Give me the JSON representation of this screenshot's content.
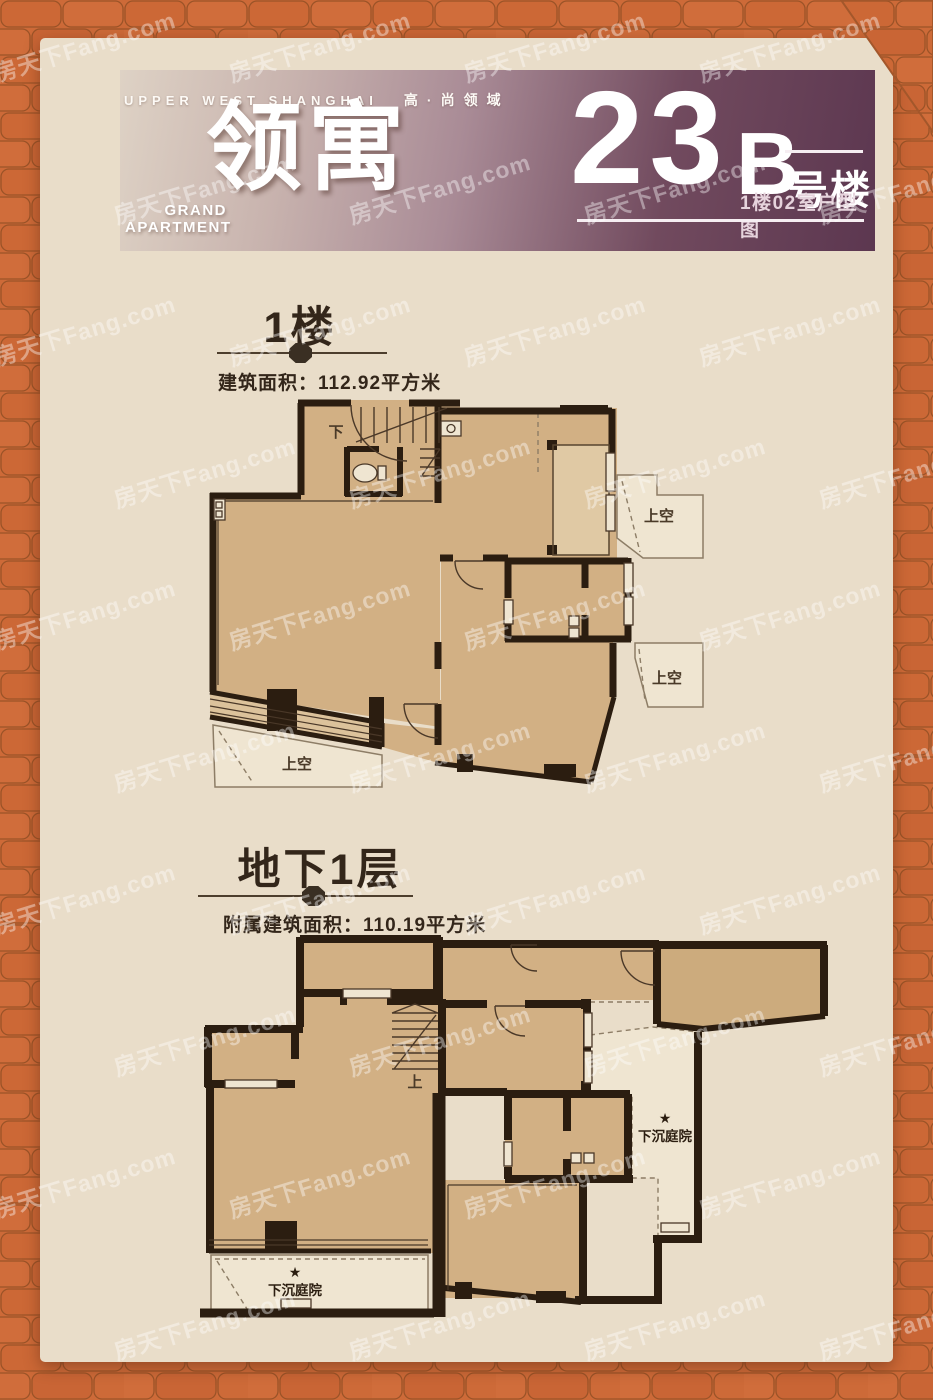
{
  "poster": {
    "tagline_en": "UPPER WEST SHANGHAI",
    "tagline_cn": "高·尚领域",
    "logo_cn": "领寓",
    "logo_en_top": "GRAND",
    "logo_en_bottom": "APARTMENT",
    "building_num": "23",
    "building_letter": "B",
    "building_suffix": "号楼",
    "unit_caption": "1楼02室户型图"
  },
  "floor1": {
    "title": "1楼",
    "area_label": "建筑面积：112.92平方米",
    "stair_direction": "下",
    "void_label": "上空"
  },
  "basement": {
    "title": "地下1层",
    "area_label": "附属建筑面积：110.19平方米",
    "stair_direction": "上",
    "courtyard_star": "★",
    "courtyard_label": "下沉庭院"
  },
  "watermark": {
    "text": "房天下Fang.com"
  },
  "colors": {
    "brick_orange": "#cd6a38",
    "brick_line": "#9b5327",
    "card_cream": "#e9ddc9",
    "header_dark": "#5c3750",
    "wall_dark": "#2b1d10",
    "room_tan": "#d2b084",
    "room_light": "#e0c9a4",
    "void_fill": "#efe5d1"
  }
}
